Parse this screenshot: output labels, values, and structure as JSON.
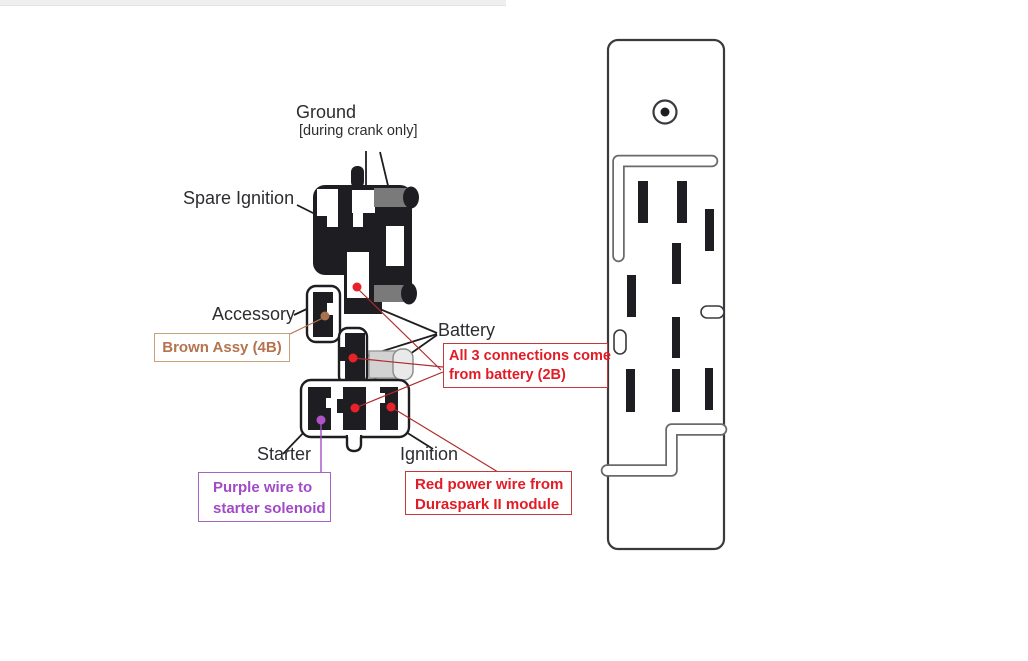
{
  "labels": {
    "ground": "Ground",
    "ground_sub": "[during crank only]",
    "spare_ignition": "Spare Ignition",
    "accessory": "Accessory",
    "battery": "Battery",
    "starter": "Starter",
    "ignition": "Ignition"
  },
  "notes": {
    "brown_assy": "Brown Assy (4B)",
    "battery_l1": "All 3 connections come",
    "battery_l2": "from battery (2B)",
    "purple_l1": "Purple wire to",
    "purple_l2": "starter solenoid",
    "red_l1": "Red power wire from",
    "red_l2": "Duraspark II module"
  },
  "colors": {
    "ink": "#1e1e22",
    "label_text": "#2d2d31",
    "red_text": "#e11c26",
    "red_border": "#c43a3a",
    "red_line": "#b02c2c",
    "red_dot": "#e8212b",
    "brown_text": "#b5734e",
    "brown_border": "#c9a07a",
    "brown_line": "#b5734e",
    "brown_dot": "#a9714e",
    "purple_text": "#a14bc6",
    "purple_border": "#a465c2",
    "purple_line": "#a54fc4",
    "purple_dot": "#b052c8",
    "terminal_gray": "#7a7a7a",
    "terminal_light": "#d2d2d2",
    "connector_stroke": "#3a3a3e",
    "groove_stroke": "#6a6a6a",
    "topbar_bg": "#efefef"
  }
}
